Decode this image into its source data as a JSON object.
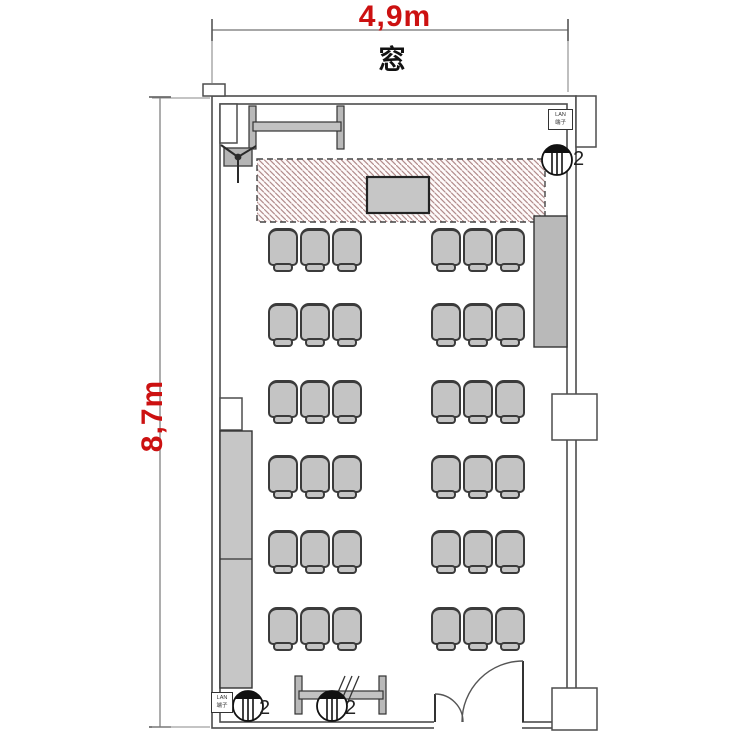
{
  "dimensions": {
    "top": "4,9m",
    "left": "8,7m"
  },
  "window_label": "窓",
  "lan_panel": {
    "line1": "LAN",
    "line2": "端子"
  },
  "speaker_label": "2",
  "seating": {
    "rows": 6,
    "groups_per_row": 2,
    "chairs_per_group": 3,
    "total_chairs": 36
  },
  "colors": {
    "dimension": "#cc1111",
    "hatch_line": "#b28c8c",
    "furniture_fill": "#c4c4c4",
    "wall": "#4d4d4d"
  }
}
